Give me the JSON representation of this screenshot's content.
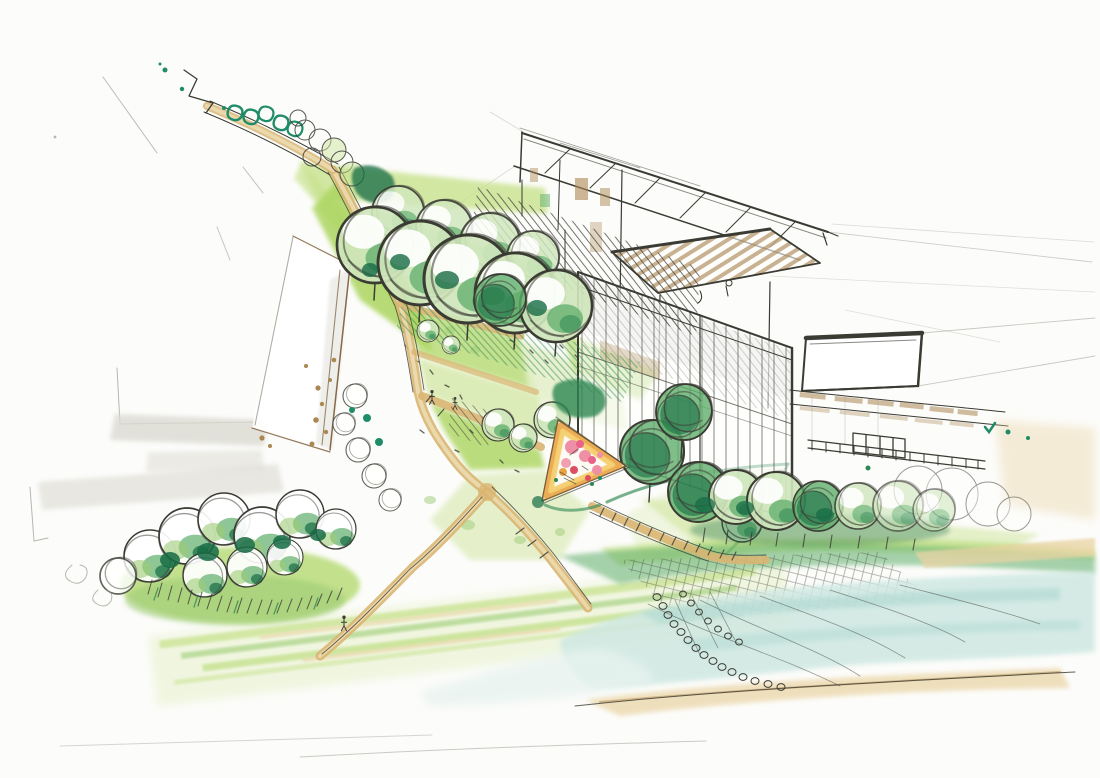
{
  "artwork": {
    "description": "Hand-drawn ink and watercolor architectural site sketch: glass pavilion with gridded sawtooth roof and white roof-deck wing at upper right, a row of round canopy trees beside lawns crossed by tan paths, a small triangular playground plaza with pink play equipment, a white bar building at left, a tree-lined avenue at upper left, bush clusters at lower left, a hedge row at right, and a lake with sandy shore at lower right.",
    "elements": [
      "pencil construction lines",
      "left bar building",
      "tree-lined avenue",
      "lawns",
      "pathways",
      "main pavilion building",
      "roof deck wing",
      "tree row",
      "playground plaza",
      "hedge row",
      "lakeside bank",
      "lake",
      "bottom-left bushes",
      "figures"
    ]
  },
  "palette": {
    "paper": "#fcfcfa",
    "ink": "#3a3b33",
    "pencil": "#9a9a90",
    "grayMarker": "#dbdad2",
    "pathTan": "#d9b572",
    "pathTanLight": "#ecdcb2",
    "brownMarker": "#ab8752",
    "brownDark": "#7a5a35",
    "lawnBright": "#abd55f",
    "lawnMid": "#c8e28d",
    "lawnPale": "#e3efc6",
    "lawnWashPale": "#eef5dc",
    "foliageLight": "#9dcc75",
    "foliageMid": "#5fae6b",
    "foliageDark": "#2f8753",
    "foliageDeep": "#176c45",
    "accentTeal": "#1e8c68",
    "water": "#cfe8e2",
    "waterDeep": "#add8d0",
    "waterPale": "#e7f3ef",
    "shoreSand": "#e9d3a2",
    "playgroundOrange": "#e9a447",
    "playgroundYellow": "#f4cd6e",
    "playgroundCream": "#faf3df",
    "playgroundPink": "#ef8fa6",
    "playgroundMagenta": "#e8628b",
    "playgroundRed": "#dc4f63"
  }
}
